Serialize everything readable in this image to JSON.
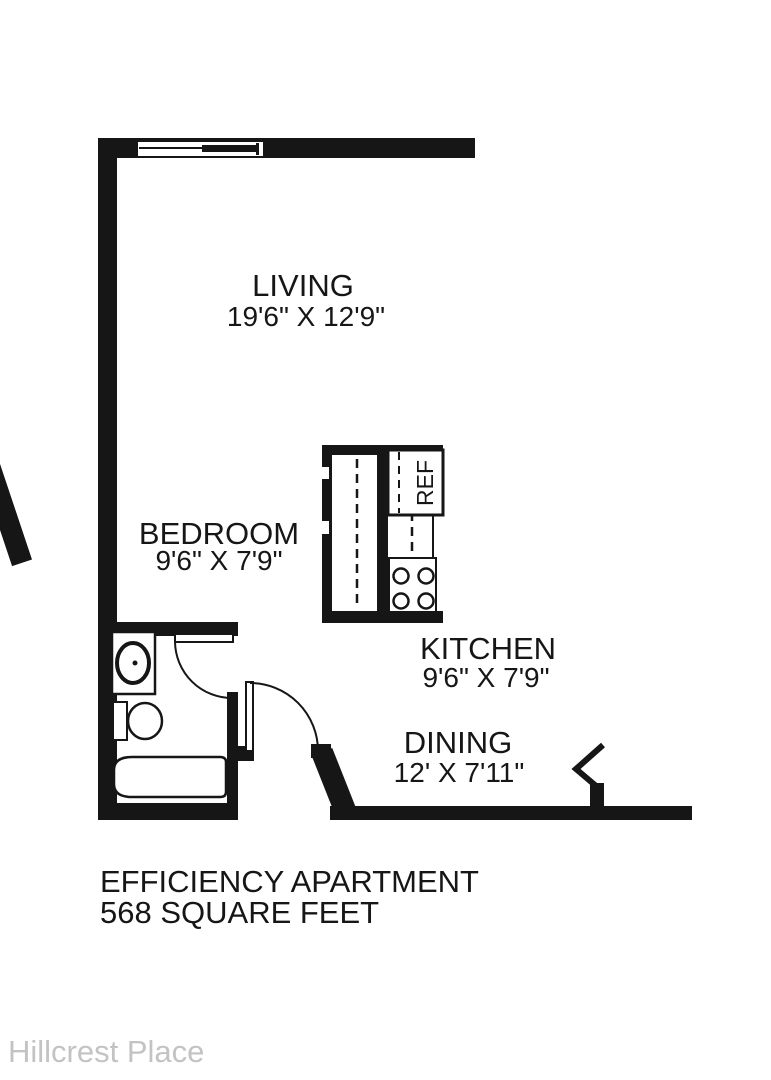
{
  "plan": {
    "type": "floor-plan",
    "caption_line1": "EFFICIENCY APARTMENT",
    "caption_line2": "568 SQUARE FEET",
    "watermark": "Hillcrest Place"
  },
  "rooms": {
    "living": {
      "name": "LIVING",
      "dims": "19'6\" X 12'9\""
    },
    "bedroom": {
      "name": "BEDROOM",
      "dims": "9'6\" X 7'9\""
    },
    "kitchen": {
      "name": "KITCHEN",
      "dims": "9'6\" X 7'9\""
    },
    "dining": {
      "name": "DINING",
      "dims": "12' X 7'11\""
    }
  },
  "appliances": {
    "refrigerator": "REF",
    "dishwasher": "DW"
  },
  "colors": {
    "wall": "#161616",
    "background": "#ffffff",
    "watermark": "#c3c3c3"
  }
}
